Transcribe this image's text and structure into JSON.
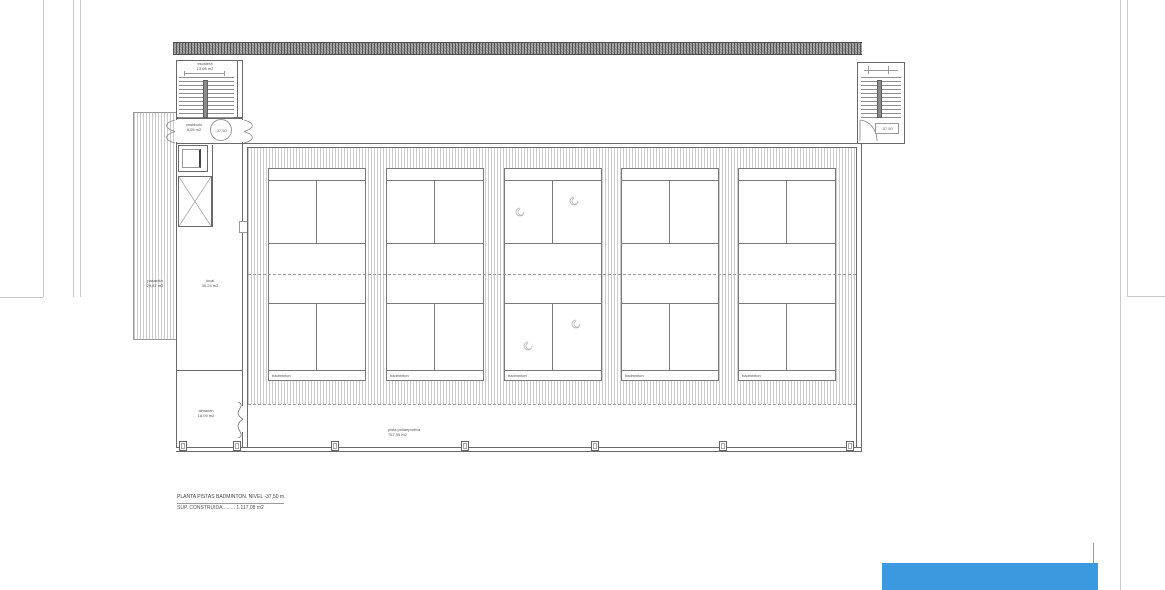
{
  "colors": {
    "accent_blue": "#3b99e0",
    "wall_line": "#6a6a6a",
    "hatch_line": "#cccccc",
    "roof_fill": "#b3b3b3"
  },
  "plan": {
    "stair_left": {
      "label": "escalera",
      "area": "13,66 m2"
    },
    "vestibule": {
      "label": "vestíbulo",
      "area": "6,05 m2"
    },
    "level_marker": "-37,50",
    "walkway": {
      "label": "pasarela",
      "area": "29,87 m2"
    },
    "local_room": {
      "label": "local",
      "area": "40,24 m2"
    },
    "storage": {
      "label": "almacén",
      "area": "18,09 m2"
    },
    "stair_right_marker": "-37,50",
    "courts": [
      {
        "label": "badminton"
      },
      {
        "label": "badminton"
      },
      {
        "label": "badminton"
      },
      {
        "label": "badminton"
      },
      {
        "label": "badminton"
      }
    ],
    "sports_area": {
      "label": "pista polideportiva",
      "area": "757,95 m2"
    },
    "title_line1": "PLANTA PISTAS BADMINTON. NIVEL -37,50 m.",
    "title_line2": "SUP. CONSTRUIDA......... 1.117,08 m2"
  }
}
